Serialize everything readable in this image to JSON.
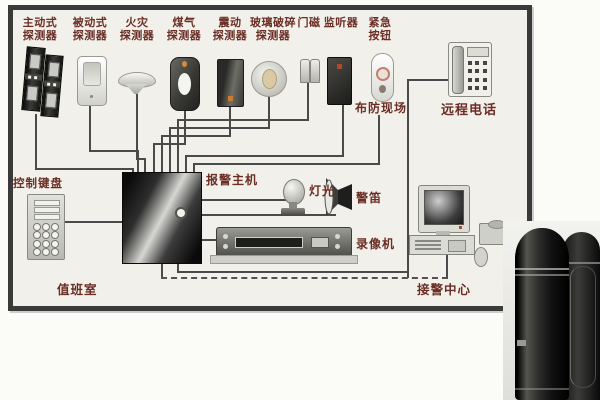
{
  "diagram": {
    "title_note": "security alarm system wiring diagram",
    "top_devices": [
      {
        "id": "active-detector",
        "label_line1": "主动式",
        "label_line2": "探测器"
      },
      {
        "id": "passive-detector",
        "label_line1": "被动式",
        "label_line2": "探测器"
      },
      {
        "id": "fire-detector",
        "label_line1": "火灾",
        "label_line2": "探测器"
      },
      {
        "id": "gas-detector",
        "label_line1": "煤气",
        "label_line2": "探测器"
      },
      {
        "id": "vibration-detector",
        "label_line1": "震动",
        "label_line2": "探测器"
      },
      {
        "id": "glass-break-detector",
        "label_line1": "玻璃破碎",
        "label_line2": "探测器"
      },
      {
        "id": "door-magnet",
        "label_line1": "门磁",
        "label_line2": ""
      },
      {
        "id": "listener",
        "label_line1": "监听器",
        "label_line2": ""
      },
      {
        "id": "emergency-button",
        "label_line1": "紧急",
        "label_line2": "按钮"
      }
    ],
    "labels": {
      "armed_site": "布防现场",
      "remote_phone": "远程电话",
      "control_keypad": "控制键盘",
      "alarm_host": "报警主机",
      "light": "灯光",
      "siren": "警笛",
      "vcr": "录像机",
      "alarm_center": "接警中心",
      "duty_room": "值班室"
    },
    "colors": {
      "label_text": "#6b2e25",
      "wire": "#4a4a4a",
      "frame_border": "#3a3a3a",
      "frame_fill": "#f1f0ea",
      "alert_orange": "#d98b3a",
      "led_red": "#b5462e"
    }
  }
}
